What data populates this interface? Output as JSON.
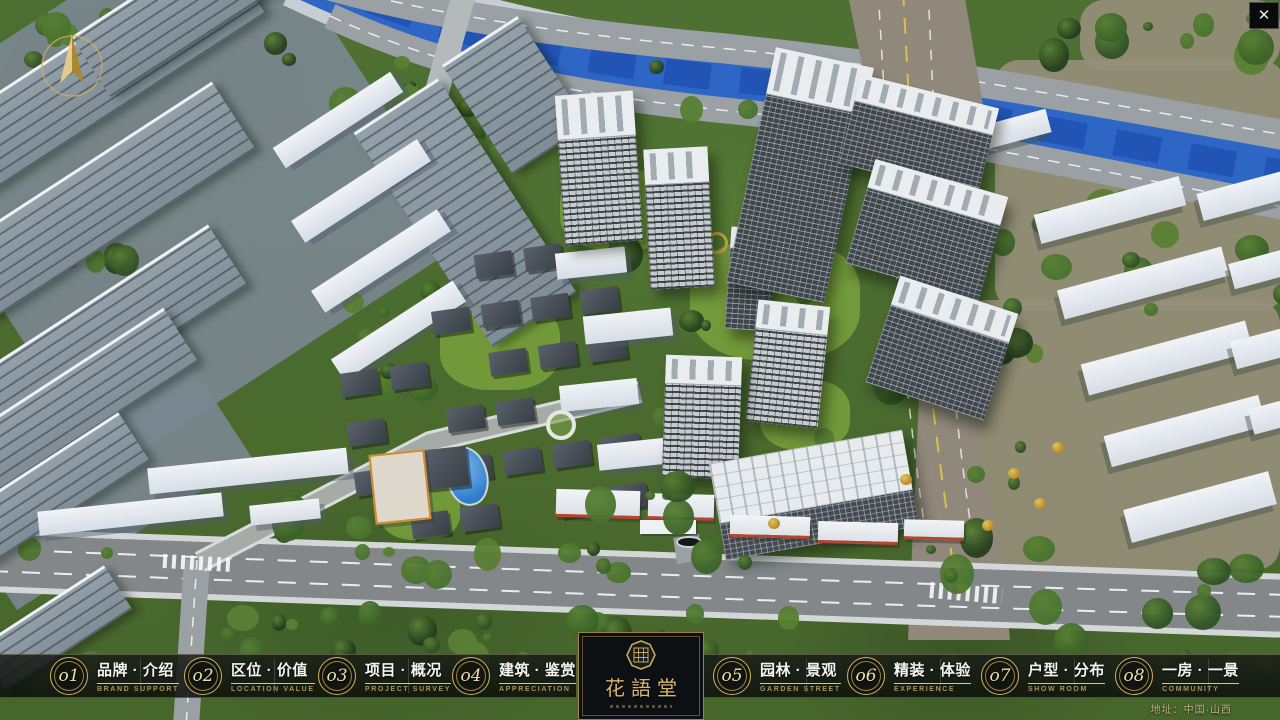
{
  "ui": {
    "close_glyph": "✕",
    "address": "地址：中国·山西",
    "logo": {
      "title": "花語堂"
    },
    "nav_items": [
      {
        "num": "o1",
        "zh": "品牌 · 介绍",
        "en": "BRAND SUPPORT"
      },
      {
        "num": "o2",
        "zh": "区位 · 价值",
        "en": "LOCATION VALUE"
      },
      {
        "num": "o3",
        "zh": "项目 · 概况",
        "en": "PROJECT SURVEY"
      },
      {
        "num": "o4",
        "zh": "建筑 · 鉴赏",
        "en": "APPRECIATION"
      },
      {
        "num": "o5",
        "zh": "园林 · 景观",
        "en": "GARDEN STREET"
      },
      {
        "num": "o6",
        "zh": "精装 · 体验",
        "en": "EXPERIENCE"
      },
      {
        "num": "o7",
        "zh": "户型 · 分布",
        "en": "SHOW ROOM"
      },
      {
        "num": "o8",
        "zh": "一房 · 一景",
        "en": "COMMUNITY"
      }
    ],
    "colors": {
      "gold": "#c9a85c",
      "bar_bg": "#10140f",
      "river": "#2e66c6"
    }
  }
}
